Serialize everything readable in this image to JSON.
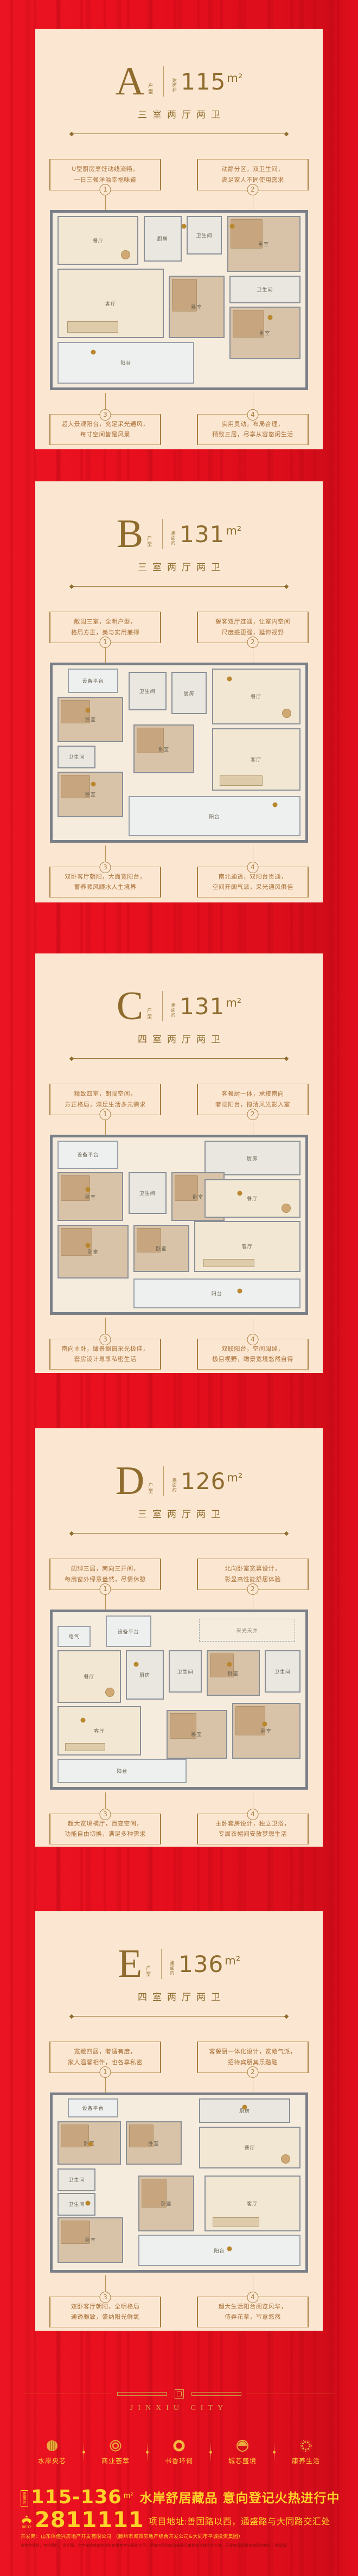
{
  "colors": {
    "background_red": "#e90f1e",
    "card_cream": "#fbe7d1",
    "bronze": "#8f6c2e",
    "callout_gold": "#a87d3f",
    "footer_gold": "#d8a64f",
    "banner_yellow": "#ffd229",
    "wall_gray": "#7b8088"
  },
  "units": [
    {
      "letter": "A",
      "letter_suffix": "户型",
      "area_prefix": "建面约",
      "area": "115",
      "area_unit": "m²",
      "layout_label": "三室两厅两卫",
      "callouts": [
        {
          "num": "1",
          "line1": "U型厨房烹饪动线流畅，",
          "line2": "一日三餐洋溢幸福味道"
        },
        {
          "num": "2",
          "line1": "动静分区，双卫生间，",
          "line2": "满足家人不同使用需求"
        },
        {
          "num": "3",
          "line1": "超大景观阳台，充足采光通风，",
          "line2": "每寸空间皆是风景"
        },
        {
          "num": "4",
          "line1": "实用灵动，布局合理，",
          "line2": "精致三居，尽享从容悠闲生活"
        }
      ],
      "rooms": [
        {
          "label": "餐厅",
          "t": "floor",
          "x": 2,
          "y": 2,
          "w": 32,
          "h": 28
        },
        {
          "label": "厨房",
          "t": "tile",
          "x": 36,
          "y": 2,
          "w": 15,
          "h": 26
        },
        {
          "label": "卫生间",
          "t": "tile",
          "x": 53,
          "y": 2,
          "w": 14,
          "h": 22
        },
        {
          "label": "卧室",
          "t": "tan",
          "x": 69,
          "y": 2,
          "w": 29,
          "h": 32
        },
        {
          "label": "客厅",
          "t": "floor",
          "x": 2,
          "y": 32,
          "w": 42,
          "h": 40
        },
        {
          "label": "卧室",
          "t": "tan",
          "x": 46,
          "y": 36,
          "w": 22,
          "h": 36
        },
        {
          "label": "卫生间",
          "t": "tile",
          "x": 70,
          "y": 36,
          "w": 28,
          "h": 16
        },
        {
          "label": "卧室",
          "t": "tan",
          "x": 70,
          "y": 54,
          "w": 28,
          "h": 30
        },
        {
          "label": "阳台",
          "t": "light",
          "x": 2,
          "y": 74,
          "w": 54,
          "h": 24
        }
      ],
      "markers": [
        {
          "x": 52,
          "y": 8
        },
        {
          "x": 71,
          "y": 8
        },
        {
          "x": 16,
          "y": 80
        },
        {
          "x": 86,
          "y": 60
        }
      ]
    },
    {
      "letter": "B",
      "letter_suffix": "户型",
      "area_prefix": "建面约",
      "area": "131",
      "area_unit": "m²",
      "layout_label": "三室两厅两卫",
      "callouts": [
        {
          "num": "1",
          "line1": "敞阔三室，全明户型，",
          "line2": "格局方正，美与实用兼得"
        },
        {
          "num": "2",
          "line1": "餐客双厅连通，让室内空间",
          "line2": "尺度感更强，延伸视野"
        },
        {
          "num": "3",
          "line1": "双卧客厅朝阳，大面宽阳台，",
          "line2": "蓄养顺风顺水人生境界"
        },
        {
          "num": "4",
          "line1": "南北通透，双阳台贯通，",
          "line2": "空间开阔气派，采光通风俱佳"
        }
      ],
      "rooms": [
        {
          "label": "设备平台",
          "t": "light",
          "x": 6,
          "y": 2,
          "w": 20,
          "h": 14
        },
        {
          "label": "卧室",
          "t": "tan",
          "x": 2,
          "y": 18,
          "w": 26,
          "h": 26
        },
        {
          "label": "卫生间",
          "t": "tile",
          "x": 30,
          "y": 4,
          "w": 15,
          "h": 22
        },
        {
          "label": "厨房",
          "t": "tile",
          "x": 47,
          "y": 4,
          "w": 14,
          "h": 24
        },
        {
          "label": "餐厅",
          "t": "floor",
          "x": 63,
          "y": 2,
          "w": 35,
          "h": 32
        },
        {
          "label": "卫生间",
          "t": "tile",
          "x": 2,
          "y": 46,
          "w": 15,
          "h": 13
        },
        {
          "label": "卧室",
          "t": "tan",
          "x": 32,
          "y": 34,
          "w": 24,
          "h": 28
        },
        {
          "label": "卧室",
          "t": "tan",
          "x": 2,
          "y": 61,
          "w": 26,
          "h": 26
        },
        {
          "label": "客厅",
          "t": "floor",
          "x": 63,
          "y": 36,
          "w": 35,
          "h": 36
        },
        {
          "label": "阳台",
          "t": "light",
          "x": 30,
          "y": 75,
          "w": 68,
          "h": 23
        }
      ],
      "markers": [
        {
          "x": 14,
          "y": 26
        },
        {
          "x": 70,
          "y": 8
        },
        {
          "x": 16,
          "y": 68
        },
        {
          "x": 88,
          "y": 80
        }
      ]
    },
    {
      "letter": "C",
      "letter_suffix": "户型",
      "area_prefix": "建面约",
      "area": "131",
      "area_unit": "m²",
      "layout_label": "四室两厅两卫",
      "callouts": [
        {
          "num": "1",
          "line1": "精致四室，朗阔空间，",
          "line2": "方正格局，满足生活多元需求"
        },
        {
          "num": "2",
          "line1": "客餐厨一体，承接南向",
          "line2": "奢阔阳台，揽清风光影入室"
        },
        {
          "num": "3",
          "line1": "南向主卧，瞰景飘窗采光极佳，",
          "line2": "套房设计尊享私密生活"
        },
        {
          "num": "4",
          "line1": "双联阳台，空间阔绰，",
          "line2": "极目视野，瞰景宽境悠然自得"
        }
      ],
      "rooms": [
        {
          "label": "设备平台",
          "t": "light",
          "x": 2,
          "y": 2,
          "w": 24,
          "h": 16
        },
        {
          "label": "厨房",
          "t": "tile",
          "x": 60,
          "y": 2,
          "w": 38,
          "h": 20
        },
        {
          "label": "卧室",
          "t": "tan",
          "x": 2,
          "y": 20,
          "w": 26,
          "h": 28
        },
        {
          "label": "卫生间",
          "t": "tile",
          "x": 30,
          "y": 20,
          "w": 15,
          "h": 24
        },
        {
          "label": "卧室",
          "t": "tan",
          "x": 47,
          "y": 20,
          "w": 21,
          "h": 28
        },
        {
          "label": "餐厅",
          "t": "floor",
          "x": 60,
          "y": 24,
          "w": 38,
          "h": 22
        },
        {
          "label": "卧室",
          "t": "tan",
          "x": 2,
          "y": 50,
          "w": 28,
          "h": 31
        },
        {
          "label": "卧室",
          "t": "tan",
          "x": 32,
          "y": 50,
          "w": 22,
          "h": 27
        },
        {
          "label": "客厅",
          "t": "floor",
          "x": 56,
          "y": 48,
          "w": 42,
          "h": 29
        },
        {
          "label": "阳台",
          "t": "light",
          "x": 32,
          "y": 81,
          "w": 66,
          "h": 17
        }
      ],
      "markers": [
        {
          "x": 14,
          "y": 30
        },
        {
          "x": 74,
          "y": 32
        },
        {
          "x": 14,
          "y": 62
        },
        {
          "x": 74,
          "y": 88
        }
      ]
    },
    {
      "letter": "D",
      "letter_suffix": "户型",
      "area_prefix": "建面约",
      "area": "126",
      "area_unit": "m²",
      "layout_label": "三室两厅两卫",
      "callouts": [
        {
          "num": "1",
          "line1": "阔绰三居，南向三开间，",
          "line2": "每扇窗外绿意盎然，尽情休憩"
        },
        {
          "num": "2",
          "line1": "北向卧室宽幕设计，",
          "line2": "彰显高性能舒居体验"
        },
        {
          "num": "3",
          "line1": "超大宽境横厅，百变空间，",
          "line2": "功能自由切换，满足多种需求"
        },
        {
          "num": "4",
          "line1": "主卧套房设计，独立卫浴，",
          "line2": "专属衣帽间安放梦想生活"
        }
      ],
      "rooms": [
        {
          "label": "电气",
          "t": "light",
          "x": 2,
          "y": 8,
          "w": 13,
          "h": 12
        },
        {
          "label": "设备平台",
          "t": "light",
          "x": 21,
          "y": 2,
          "w": 18,
          "h": 18
        },
        {
          "label": "采光天井",
          "t": "open",
          "x": 58,
          "y": 4,
          "w": 38,
          "h": 13
        },
        {
          "label": "餐厅",
          "t": "floor",
          "x": 2,
          "y": 22,
          "w": 25,
          "h": 30
        },
        {
          "label": "厨房",
          "t": "tile",
          "x": 29,
          "y": 22,
          "w": 15,
          "h": 28
        },
        {
          "label": "卫生间",
          "t": "tile",
          "x": 46,
          "y": 22,
          "w": 13,
          "h": 24
        },
        {
          "label": "卧室",
          "t": "tan",
          "x": 61,
          "y": 22,
          "w": 21,
          "h": 26
        },
        {
          "label": "卫生间",
          "t": "tile",
          "x": 84,
          "y": 22,
          "w": 14,
          "h": 24
        },
        {
          "label": "客厅",
          "t": "floor",
          "x": 2,
          "y": 54,
          "w": 33,
          "h": 28
        },
        {
          "label": "卧室",
          "t": "tan",
          "x": 45,
          "y": 56,
          "w": 24,
          "h": 28
        },
        {
          "label": "卧室",
          "t": "tan",
          "x": 71,
          "y": 52,
          "w": 27,
          "h": 32
        },
        {
          "label": "阳台",
          "t": "light",
          "x": 2,
          "y": 84,
          "w": 51,
          "h": 14
        }
      ],
      "markers": [
        {
          "x": 33,
          "y": 30
        },
        {
          "x": 70,
          "y": 30
        },
        {
          "x": 12,
          "y": 62
        },
        {
          "x": 84,
          "y": 64
        }
      ]
    },
    {
      "letter": "E",
      "letter_suffix": "户型",
      "area_prefix": "建面约",
      "area": "136",
      "area_unit": "m²",
      "layout_label": "四室两厅两卫",
      "callouts": [
        {
          "num": "1",
          "line1": "宽敞四居，奢适有度，",
          "line2": "家人温馨相伴，也各享私密"
        },
        {
          "num": "2",
          "line1": "客餐厨一体化设计，宽敞气派，",
          "line2": "招待宾朋其乐融融"
        },
        {
          "num": "3",
          "line1": "双卧客厅朝阳，全明格局",
          "line2": "通透雅致，盛纳阳光鲜氧"
        },
        {
          "num": "4",
          "line1": "超大生活阳台阅览风华，",
          "line2": "侍弄花草，写意悠然"
        }
      ],
      "rooms": [
        {
          "label": "设备平台",
          "t": "light",
          "x": 6,
          "y": 2,
          "w": 20,
          "h": 11
        },
        {
          "label": "厨房",
          "t": "tile",
          "x": 58,
          "y": 2,
          "w": 36,
          "h": 14
        },
        {
          "label": "卧室",
          "t": "tan",
          "x": 2,
          "y": 15,
          "w": 25,
          "h": 25
        },
        {
          "label": "卧室",
          "t": "tan",
          "x": 29,
          "y": 15,
          "w": 22,
          "h": 25
        },
        {
          "label": "餐厅",
          "t": "floor",
          "x": 58,
          "y": 18,
          "w": 40,
          "h": 24
        },
        {
          "label": "卫生间",
          "t": "tile",
          "x": 2,
          "y": 42,
          "w": 15,
          "h": 13
        },
        {
          "label": "卫生间",
          "t": "tile",
          "x": 2,
          "y": 56,
          "w": 15,
          "h": 13
        },
        {
          "label": "卧室",
          "t": "tan",
          "x": 2,
          "y": 70,
          "w": 26,
          "h": 26
        },
        {
          "label": "卧室",
          "t": "tan",
          "x": 34,
          "y": 46,
          "w": 22,
          "h": 32
        },
        {
          "label": "客厅",
          "t": "floor",
          "x": 60,
          "y": 46,
          "w": 38,
          "h": 32
        },
        {
          "label": "阳台",
          "t": "light",
          "x": 34,
          "y": 80,
          "w": 64,
          "h": 18
        }
      ],
      "markers": [
        {
          "x": 15,
          "y": 28
        },
        {
          "x": 76,
          "y": 7
        },
        {
          "x": 14,
          "y": 62
        },
        {
          "x": 70,
          "y": 88
        }
      ]
    }
  ],
  "footer": {
    "brand": "JINXIU CITY",
    "features": [
      {
        "label": "水岸央芯",
        "icon": "water-core-icon"
      },
      {
        "label": "商业荟萃",
        "icon": "business-rings-icon"
      },
      {
        "label": "书香环伺",
        "icon": "book-ring-icon"
      },
      {
        "label": "城芯盛境",
        "icon": "city-core-icon"
      },
      {
        "label": "康养生活",
        "icon": "wellness-sun-icon"
      }
    ],
    "banner": {
      "area_tag": "建面约",
      "area_range": "115-136",
      "area_unit": "m²",
      "headline": "水岸舒居藏品  意向登记火热进行中",
      "phone": "2811111",
      "area_code": "0632",
      "address": "项目地址:善国路以西，通盛路与大同路交汇处",
      "developer": "开发商：山东佰佳兴房地产开发有限公司 （滕州市城郊房地产综合开发公司&大同市平城投资集团）",
      "disclaimer": "本宣传资料，包括图片、设计图、文字描述或其他资料仅供参考与识别之用，所有内容均以政府最后审批或法律文件为准，开发商保留最终修改的权利，敬请留意最新资料，本广告于2024年7月发布。"
    }
  }
}
